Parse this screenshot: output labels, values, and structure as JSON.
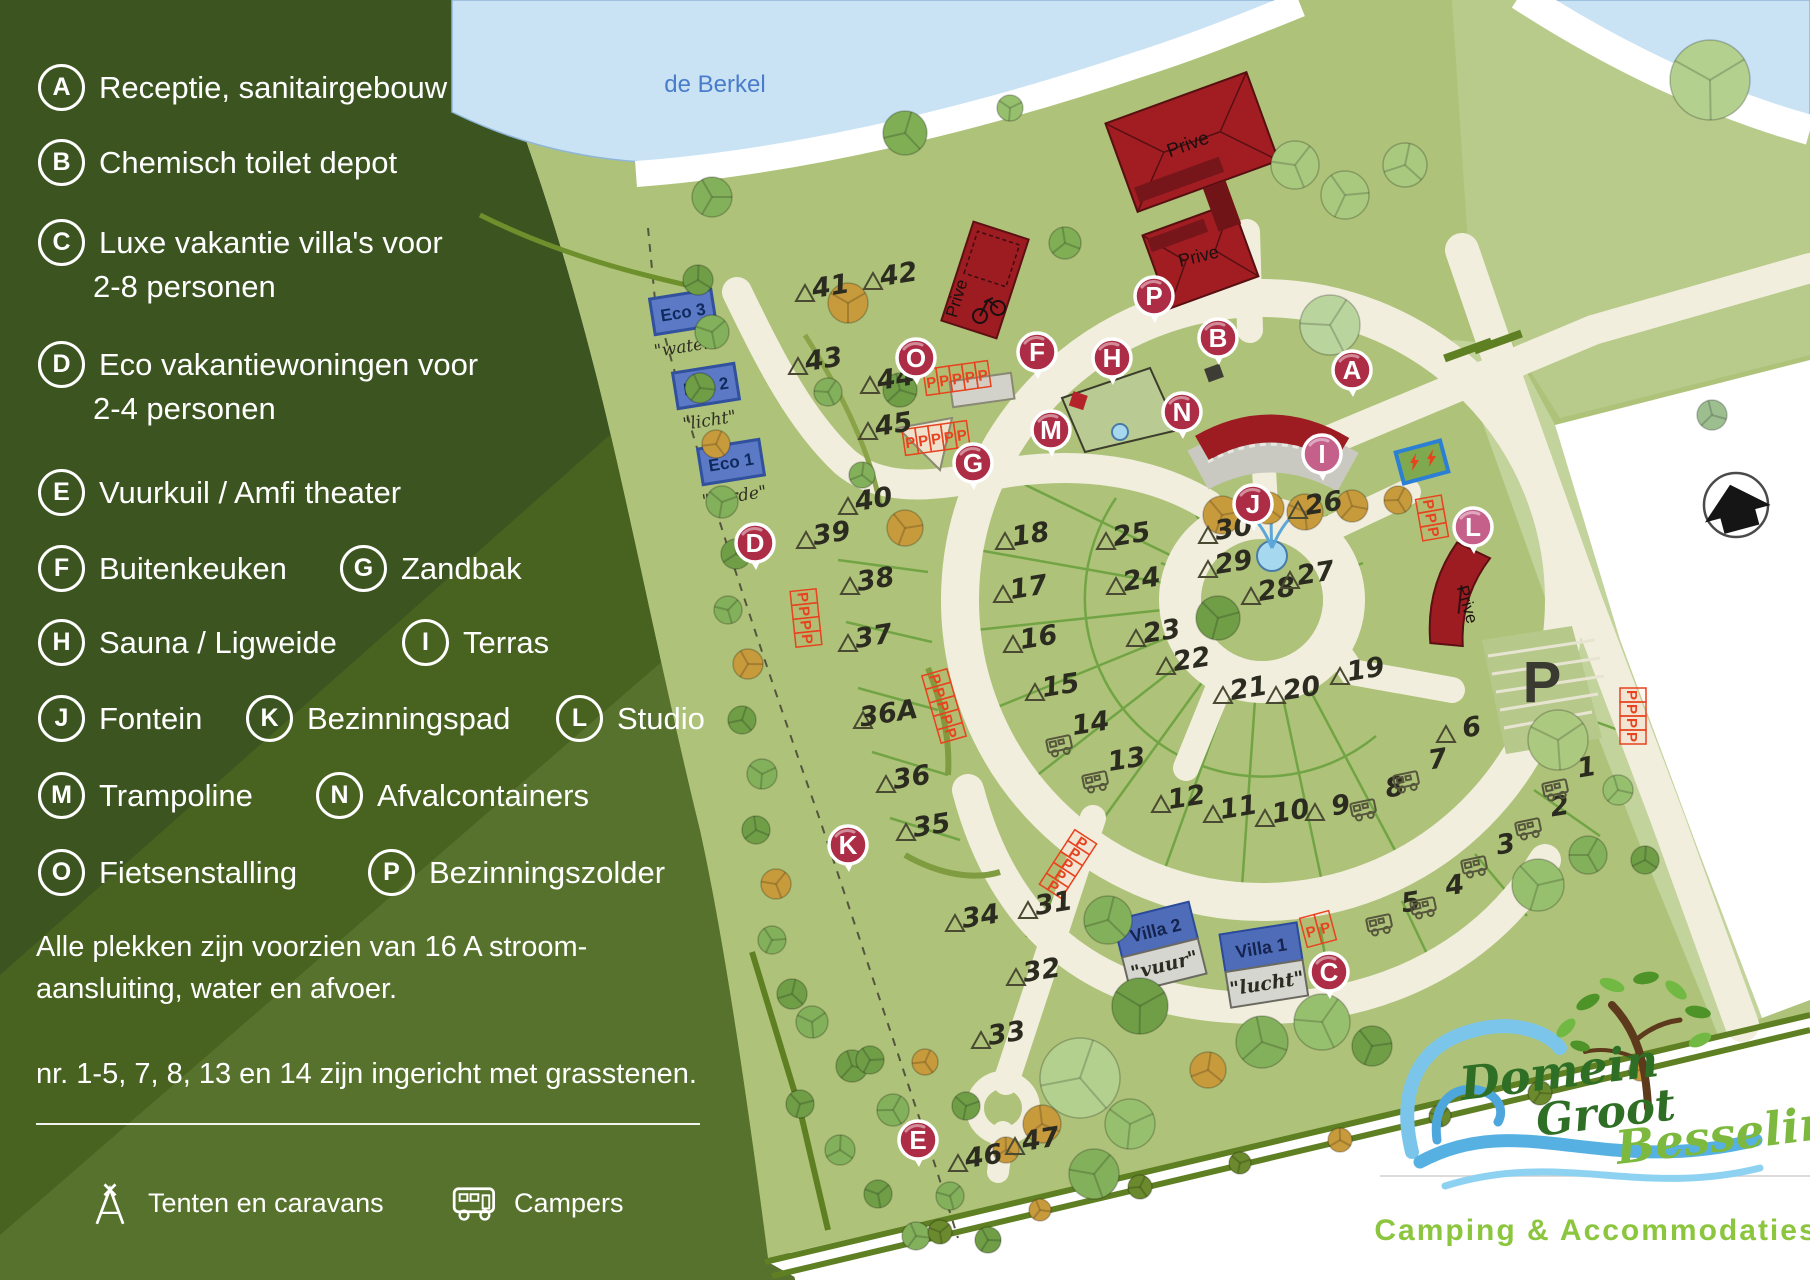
{
  "legend": {
    "rows": [
      {
        "y": 85,
        "items": [
          {
            "letter": "A",
            "text": "Receptie, sanitairgebouw"
          }
        ]
      },
      {
        "y": 160,
        "items": [
          {
            "letter": "B",
            "text": "Chemisch toilet depot"
          }
        ]
      },
      {
        "y": 240,
        "items": [
          {
            "letter": "C",
            "text": "Luxe vakantie villa's voor"
          }
        ]
      },
      {
        "y": 362,
        "items": [
          {
            "letter": "D",
            "text": "Eco vakantiewoningen voor"
          }
        ]
      },
      {
        "y": 490,
        "items": [
          {
            "letter": "E",
            "text": "Vuurkuil / Amfi theater"
          }
        ]
      },
      {
        "y": 566,
        "items": [
          {
            "letter": "F",
            "text": "Buitenkeuken"
          },
          {
            "letter": "G",
            "text": "Zandbak",
            "x": 340
          }
        ]
      },
      {
        "y": 640,
        "items": [
          {
            "letter": "H",
            "text": "Sauna / Ligweide"
          },
          {
            "letter": "I",
            "text": "Terras",
            "x": 402
          }
        ]
      },
      {
        "y": 716,
        "items": [
          {
            "letter": "J",
            "text": "Fontein"
          },
          {
            "letter": "K",
            "text": "Bezinningspad",
            "x": 246
          },
          {
            "letter": "L",
            "text": "Studio",
            "x": 556
          }
        ]
      },
      {
        "y": 793,
        "items": [
          {
            "letter": "M",
            "text": "Trampoline"
          },
          {
            "letter": "N",
            "text": "Afvalcontainers",
            "x": 316
          }
        ]
      },
      {
        "y": 870,
        "items": [
          {
            "letter": "O",
            "text": "Fietsenstalling"
          },
          {
            "letter": "P",
            "text": "Bezinningszolder",
            "x": 368
          }
        ]
      }
    ],
    "extra_lines": [
      {
        "y": 287,
        "text": "2-8 personen"
      },
      {
        "y": 409,
        "text": "2-4 personen"
      }
    ],
    "note1a": "Alle plekken zijn voorzien van 16 A stroom-",
    "note1b": "aansluiting, water en afvoer.",
    "note2": "nr. 1-5, 7, 8, 13 en 14 zijn ingericht met grasstenen.",
    "key": [
      {
        "icon": "tent-icon",
        "label": "Tenten en caravans"
      },
      {
        "icon": "camper-icon",
        "label": "Campers"
      }
    ]
  },
  "map": {
    "colors": {
      "panel": "#3c5420",
      "field": "#aec379",
      "water": "#c9e3f4",
      "road": "#f2eede",
      "marker_red": "#ad2d46",
      "marker_pink": "#c4608a",
      "building_red": "#9c1c22",
      "parking_red": "#e8421e",
      "pitch_text": "#2b2b20"
    },
    "labels": [
      {
        "t": "de Berkel",
        "x": 715,
        "y": 92,
        "s": 24,
        "c": "#4a7ccc"
      },
      {
        "t": "Prive",
        "x": 1190,
        "y": 150,
        "s": 19,
        "c": "#1c0f0f",
        "r": -20
      },
      {
        "t": "Prive",
        "x": 1200,
        "y": 262,
        "s": 18,
        "c": "#1c0f0f",
        "r": -14
      },
      {
        "t": "Prive",
        "x": 962,
        "y": 300,
        "s": 17,
        "c": "#1c0f0f",
        "r": -73
      },
      {
        "t": "Prive",
        "x": 1462,
        "y": 606,
        "s": 17,
        "c": "#1c0f0f",
        "r": 74
      },
      {
        "t": "P",
        "x": 1542,
        "y": 702,
        "s": 58,
        "c": "#3a3a30",
        "w": "bold"
      },
      {
        "t": "N",
        "x": 1737,
        "y": 514,
        "s": 20,
        "c": "#ffffff",
        "w": "bold",
        "r": -15
      }
    ],
    "cabins": [
      {
        "name": "Eco 3",
        "sub": "\"water\"",
        "x": 683,
        "y": 312
      },
      {
        "name": "Eco 2",
        "sub": "\"licht\"",
        "x": 706,
        "y": 386
      },
      {
        "name": "Eco 1",
        "sub": "\"aarde\"",
        "x": 731,
        "y": 462
      }
    ],
    "villas": [
      {
        "name": "Villa 2",
        "sub": "\"vuur\"",
        "x": 1160,
        "y": 948,
        "rot": -14
      },
      {
        "name": "Villa 1",
        "sub": "\"lucht\"",
        "x": 1264,
        "y": 966,
        "rot": -9
      }
    ],
    "markers": [
      {
        "l": "A",
        "x": 1352,
        "y": 370
      },
      {
        "l": "B",
        "x": 1218,
        "y": 338
      },
      {
        "l": "C",
        "x": 1329,
        "y": 972
      },
      {
        "l": "D",
        "x": 755,
        "y": 543
      },
      {
        "l": "E",
        "x": 918,
        "y": 1140
      },
      {
        "l": "F",
        "x": 1037,
        "y": 352
      },
      {
        "l": "G",
        "x": 973,
        "y": 463
      },
      {
        "l": "H",
        "x": 1112,
        "y": 358
      },
      {
        "l": "I",
        "x": 1322,
        "y": 454,
        "c": "#c4608a"
      },
      {
        "l": "J",
        "x": 1253,
        "y": 504
      },
      {
        "l": "K",
        "x": 848,
        "y": 845
      },
      {
        "l": "L",
        "x": 1473,
        "y": 527,
        "c": "#c4608a"
      },
      {
        "l": "M",
        "x": 1051,
        "y": 430
      },
      {
        "l": "N",
        "x": 1182,
        "y": 412
      },
      {
        "l": "O",
        "x": 916,
        "y": 358
      },
      {
        "l": "P",
        "x": 1154,
        "y": 296
      }
    ],
    "pitches": [
      {
        "n": "41",
        "x": 832,
        "y": 295,
        "i": "t"
      },
      {
        "n": "42",
        "x": 900,
        "y": 283,
        "i": "t"
      },
      {
        "n": "43",
        "x": 825,
        "y": 368,
        "i": "t"
      },
      {
        "n": "44",
        "x": 897,
        "y": 387,
        "i": "t"
      },
      {
        "n": "45",
        "x": 895,
        "y": 433,
        "i": "t"
      },
      {
        "n": "40",
        "x": 875,
        "y": 508,
        "i": "t"
      },
      {
        "n": "39",
        "x": 833,
        "y": 542,
        "i": "t"
      },
      {
        "n": "38",
        "x": 877,
        "y": 588,
        "i": "t"
      },
      {
        "n": "37",
        "x": 875,
        "y": 645,
        "i": "t"
      },
      {
        "n": "36A",
        "x": 890,
        "y": 722,
        "i": "t"
      },
      {
        "n": "36",
        "x": 913,
        "y": 786,
        "i": "t"
      },
      {
        "n": "35",
        "x": 933,
        "y": 834,
        "i": "t"
      },
      {
        "n": "34",
        "x": 982,
        "y": 925,
        "i": "t"
      },
      {
        "n": "31",
        "x": 1055,
        "y": 912,
        "i": "t"
      },
      {
        "n": "32",
        "x": 1043,
        "y": 979,
        "i": "t"
      },
      {
        "n": "33",
        "x": 1008,
        "y": 1042,
        "i": "t"
      },
      {
        "n": "46",
        "x": 985,
        "y": 1165,
        "i": "t"
      },
      {
        "n": "47",
        "x": 1042,
        "y": 1148,
        "i": "t"
      },
      {
        "n": "18",
        "x": 1032,
        "y": 543,
        "i": "t"
      },
      {
        "n": "17",
        "x": 1030,
        "y": 596,
        "i": "t"
      },
      {
        "n": "16",
        "x": 1040,
        "y": 646,
        "i": "t"
      },
      {
        "n": "15",
        "x": 1062,
        "y": 694,
        "i": "t"
      },
      {
        "n": "14",
        "x": 1092,
        "y": 732,
        "i": "c"
      },
      {
        "n": "13",
        "x": 1128,
        "y": 768,
        "i": "c"
      },
      {
        "n": "12",
        "x": 1188,
        "y": 806,
        "i": "t"
      },
      {
        "n": "11",
        "x": 1240,
        "y": 816,
        "i": "t"
      },
      {
        "n": "10",
        "x": 1292,
        "y": 820,
        "i": "t"
      },
      {
        "n": "9",
        "x": 1342,
        "y": 814,
        "i": "t"
      },
      {
        "n": "8",
        "x": 1396,
        "y": 796,
        "i": "c"
      },
      {
        "n": "7",
        "x": 1439,
        "y": 768,
        "i": "c"
      },
      {
        "n": "6",
        "x": 1473,
        "y": 736,
        "i": "t"
      },
      {
        "n": "5",
        "x": 1412,
        "y": 911,
        "i": "c"
      },
      {
        "n": "4",
        "x": 1456,
        "y": 894,
        "i": "c"
      },
      {
        "n": "3",
        "x": 1507,
        "y": 853,
        "i": "c"
      },
      {
        "n": "2",
        "x": 1561,
        "y": 815,
        "i": "c"
      },
      {
        "n": "1",
        "x": 1588,
        "y": 776,
        "i": "c"
      },
      {
        "n": "25",
        "x": 1133,
        "y": 543,
        "i": "t"
      },
      {
        "n": "24",
        "x": 1143,
        "y": 588,
        "i": "t"
      },
      {
        "n": "23",
        "x": 1163,
        "y": 640,
        "i": "t"
      },
      {
        "n": "22",
        "x": 1193,
        "y": 668,
        "i": "t"
      },
      {
        "n": "21",
        "x": 1250,
        "y": 697,
        "i": "t"
      },
      {
        "n": "20",
        "x": 1303,
        "y": 697,
        "i": "t"
      },
      {
        "n": "19",
        "x": 1367,
        "y": 678,
        "i": "t"
      },
      {
        "n": "30",
        "x": 1235,
        "y": 537,
        "i": "t"
      },
      {
        "n": "29",
        "x": 1235,
        "y": 571,
        "i": "t"
      },
      {
        "n": "28",
        "x": 1278,
        "y": 598,
        "i": "t"
      },
      {
        "n": "27",
        "x": 1317,
        "y": 582,
        "i": "t"
      },
      {
        "n": "26",
        "x": 1325,
        "y": 512,
        "i": "t"
      }
    ],
    "parking_grids": [
      {
        "x": 957,
        "y": 378,
        "rot": -8,
        "n": 5,
        "lr": 0,
        "w": 13,
        "h": 26
      },
      {
        "x": 936,
        "y": 438,
        "rot": -8,
        "n": 5,
        "lr": 0,
        "w": 13,
        "h": 26
      },
      {
        "x": 806,
        "y": 618,
        "rot": 84,
        "n": 4,
        "lr": 0,
        "w": 14,
        "h": 26
      },
      {
        "x": 944,
        "y": 706,
        "rot": 74,
        "n": 5,
        "lr": 0,
        "w": 14,
        "h": 26
      },
      {
        "x": 1068,
        "y": 864,
        "rot": -57,
        "n": 5,
        "lr": 90,
        "w": 13,
        "h": 26
      },
      {
        "x": 1432,
        "y": 518,
        "rot": 80,
        "n": 3,
        "lr": 0,
        "w": 14,
        "h": 26
      },
      {
        "x": 1633,
        "y": 716,
        "rot": 90,
        "n": 4,
        "lr": 0,
        "w": 14,
        "h": 26
      },
      {
        "x": 1318,
        "y": 929,
        "rot": -15,
        "n": 2,
        "lr": 0,
        "w": 15,
        "h": 30
      }
    ],
    "trees": [
      [
        712,
        197,
        20,
        "#83b05a"
      ],
      [
        905,
        133,
        22,
        "#7fae55"
      ],
      [
        1010,
        108,
        13,
        "#97c06e"
      ],
      [
        1065,
        243,
        16,
        "#7fae55"
      ],
      [
        1295,
        165,
        24,
        "#a9c97f"
      ],
      [
        1345,
        195,
        24,
        "#a9c97f"
      ],
      [
        1405,
        165,
        22,
        "#a9c97f"
      ],
      [
        1710,
        80,
        40,
        "#b3d08e"
      ],
      [
        1712,
        415,
        15,
        "#9dbf90"
      ],
      [
        1330,
        325,
        30,
        "#b9d49c"
      ],
      [
        1222,
        515,
        19,
        "#c79a3c"
      ],
      [
        1268,
        508,
        16,
        "#c79a3c"
      ],
      [
        1305,
        512,
        18,
        "#c79a3c"
      ],
      [
        1352,
        506,
        16,
        "#c79a3c"
      ],
      [
        1398,
        500,
        14,
        "#c79a3c"
      ],
      [
        1218,
        618,
        22,
        "#6f9e47"
      ],
      [
        698,
        280,
        15,
        "#6f9e47"
      ],
      [
        712,
        332,
        17,
        "#83b05a"
      ],
      [
        700,
        388,
        15,
        "#6f9e47"
      ],
      [
        716,
        444,
        14,
        "#c79a3c"
      ],
      [
        722,
        502,
        16,
        "#83b05a"
      ],
      [
        736,
        554,
        15,
        "#6f9e47"
      ],
      [
        728,
        610,
        14,
        "#83b05a"
      ],
      [
        748,
        664,
        15,
        "#c79a3c"
      ],
      [
        742,
        720,
        14,
        "#6f9e47"
      ],
      [
        762,
        774,
        15,
        "#83b05a"
      ],
      [
        756,
        830,
        14,
        "#6f9e47"
      ],
      [
        776,
        884,
        15,
        "#c79a3c"
      ],
      [
        772,
        940,
        14,
        "#83b05a"
      ],
      [
        792,
        994,
        15,
        "#6f9e47"
      ],
      [
        848,
        303,
        20,
        "#c79a3c"
      ],
      [
        900,
        390,
        17,
        "#6f9e47"
      ],
      [
        828,
        392,
        14,
        "#83b05a"
      ],
      [
        905,
        528,
        18,
        "#c79a3c"
      ],
      [
        862,
        475,
        13,
        "#83b05a"
      ],
      [
        812,
        1022,
        16,
        "#83b05a"
      ],
      [
        852,
        1066,
        16,
        "#6f9e47"
      ],
      [
        893,
        1110,
        16,
        "#83b05a"
      ],
      [
        800,
        1104,
        14,
        "#6f9e47"
      ],
      [
        840,
        1150,
        15,
        "#83b05a"
      ],
      [
        878,
        1194,
        14,
        "#6f9e47"
      ],
      [
        916,
        1236,
        14,
        "#83b05a"
      ],
      [
        925,
        1062,
        13,
        "#c79a3c"
      ],
      [
        966,
        1106,
        14,
        "#6f9e47"
      ],
      [
        1006,
        1150,
        13,
        "#c79a3c"
      ],
      [
        950,
        1196,
        14,
        "#83b05a"
      ],
      [
        988,
        1240,
        13,
        "#6f9e47"
      ],
      [
        1080,
        1078,
        40,
        "#b3d08e"
      ],
      [
        1130,
        1124,
        25,
        "#97c06e"
      ],
      [
        1042,
        1124,
        19,
        "#c79a3c"
      ],
      [
        1094,
        1174,
        25,
        "#83b05a"
      ],
      [
        870,
        1060,
        14,
        "#6f9e47"
      ],
      [
        1108,
        920,
        24,
        "#83b05a"
      ],
      [
        1140,
        1006,
        28,
        "#6f9e47"
      ],
      [
        1262,
        1042,
        26,
        "#83b05a"
      ],
      [
        1322,
        1022,
        28,
        "#97c06e"
      ],
      [
        1372,
        1046,
        20,
        "#6f9e47"
      ],
      [
        1208,
        1070,
        18,
        "#c79a3c"
      ],
      [
        1558,
        740,
        30,
        "#abc97f"
      ],
      [
        1618,
        790,
        15,
        "#97c06e"
      ],
      [
        1588,
        855,
        19,
        "#83b05a"
      ],
      [
        1538,
        885,
        26,
        "#97c06e"
      ],
      [
        1645,
        860,
        14,
        "#6f9e47"
      ],
      [
        940,
        1232,
        12,
        "#6b8a2d"
      ],
      [
        1040,
        1210,
        11,
        "#c79a3c"
      ],
      [
        1140,
        1187,
        12,
        "#6b8a2d"
      ],
      [
        1240,
        1163,
        11,
        "#6b8a2d"
      ],
      [
        1340,
        1140,
        12,
        "#c79a3c"
      ],
      [
        1440,
        1116,
        11,
        "#6b8a2d"
      ],
      [
        1540,
        1093,
        12,
        "#6b8a2d"
      ],
      [
        1640,
        1070,
        11,
        "#c79a3c"
      ]
    ]
  },
  "logo": {
    "name1": "Domein",
    "name2": "Groot",
    "name3": "Besselink",
    "tagline": "Camping & Accommodaties"
  }
}
